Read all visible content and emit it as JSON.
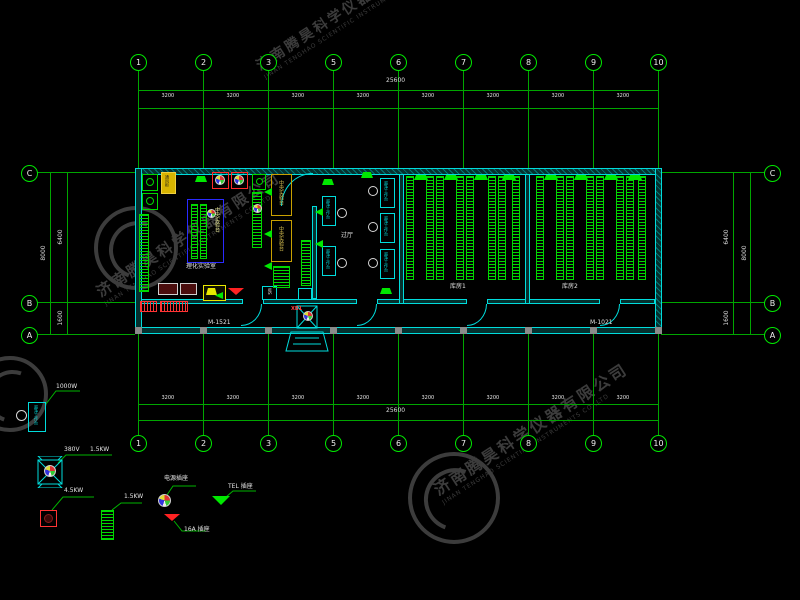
{
  "watermark": {
    "cn": "济南腾昊科学仪器有限公司",
    "en": "JINAN TENGHAO SCIENTIFIC INSTRUMENTS CO.,LTD"
  },
  "axes": {
    "columns": [
      "1",
      "2",
      "3",
      "5",
      "6",
      "7",
      "8",
      "9",
      "10"
    ],
    "rows": [
      "C",
      "B",
      "A"
    ],
    "bay": "3200",
    "total": "25600",
    "side": {
      "overall": "8000",
      "upper": "6400",
      "lower": "1600"
    }
  },
  "plan": {
    "rooms": {
      "lab": "理化实验室",
      "hall": "过厅",
      "store1": "库房1",
      "store2": "库房2"
    },
    "doors": {
      "left": "M-1521",
      "right": "M-1021"
    },
    "power_box": "XB1",
    "ws": "WS",
    "central_bench": "中央实验台",
    "clean_bench": "超净工作台",
    "fume_hood": "通风柜"
  },
  "legend": {
    "clean_bench_text": "超净工作台",
    "clean_bench_power": "1000W",
    "fan_voltage": "380V",
    "fan_power": "1.5KW",
    "exhaust_power": "4.5KW",
    "rack_power": "1.5KW",
    "socket": "电源插座",
    "socket_16a": "16A 插座",
    "socket_tel": "TEL 插座"
  },
  "colors": {
    "grid": "#00a600",
    "bright": "#00e800",
    "cyan": "#00dcdc",
    "red": "#ff2a2a",
    "yellow": "#d8b400",
    "blue": "#2a2aff",
    "text": "#e4e4e4",
    "watermark": "#3c3c3c"
  }
}
